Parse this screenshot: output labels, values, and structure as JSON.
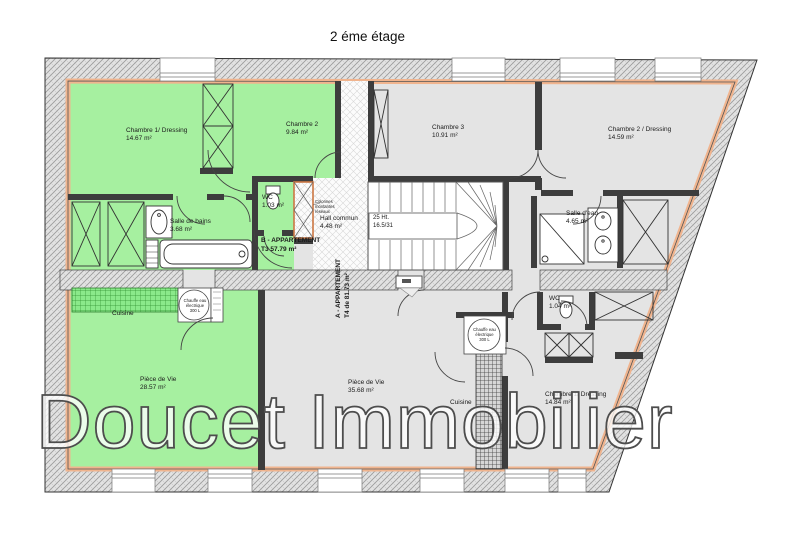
{
  "title": "2 éme étage",
  "watermark": "Doucet Immobilier",
  "apartment_a": {
    "name": "A - APPARTEMENT",
    "detail": "T4 de 81.73 m²"
  },
  "apartment_b": {
    "name": "B - APPARTEMENT",
    "detail": "T3  57.79  m²"
  },
  "rooms": {
    "chambre1_b": {
      "name": "Chambre 1/ Dressing",
      "area": "14.67 m²"
    },
    "chambre2_b": {
      "name": "Chambre 2",
      "area": "9.84 m²"
    },
    "salle_de_bains_b": {
      "name": "Salle de bains",
      "area": "3.68 m²"
    },
    "wc_b": {
      "name": "WC",
      "area": "1.03 m²"
    },
    "cuisine_b": {
      "name": "Cuisine"
    },
    "piece_de_vie_b": {
      "name": "Pièce  de Vie",
      "area": "28.57 m²"
    },
    "hall": {
      "name": "Hall commun",
      "area": "4.48 m²"
    },
    "chambre3_a": {
      "name": "Chambre 3",
      "area": "10.91 m²"
    },
    "chambre2_a": {
      "name": "Chambre 2 / Dressing",
      "area": "14.59 m²"
    },
    "salle_eau_a": {
      "name": "Salle d'eau",
      "area": "4.65 m²"
    },
    "wc_a": {
      "name": "WC",
      "area": "1.04 m²"
    },
    "piece_de_vie_a": {
      "name": "Pièce de Vie",
      "area": "35.68 m²"
    },
    "cuisine_a": {
      "name": "Cuisine"
    },
    "chambre1_a": {
      "name": "Chambre 1/ Dressing",
      "area": "14.84 m²"
    }
  },
  "annotations": {
    "stairs": {
      "line1": "25 Ht.",
      "line2": "16.5/31"
    },
    "colonnes": {
      "line1": "Colonnes",
      "line2": "montantes",
      "line3": "réseaux"
    },
    "chauffe_eau": {
      "line1": "Chauffe eau",
      "line2": "électrique",
      "line3": "300 L"
    }
  },
  "colors": {
    "apartment_b_fill": "#a6f0a0",
    "apartment_a_fill": "#e4e4e4",
    "wall_lining": "#f0b48e",
    "wall_hatch": "#e2e2e2"
  }
}
